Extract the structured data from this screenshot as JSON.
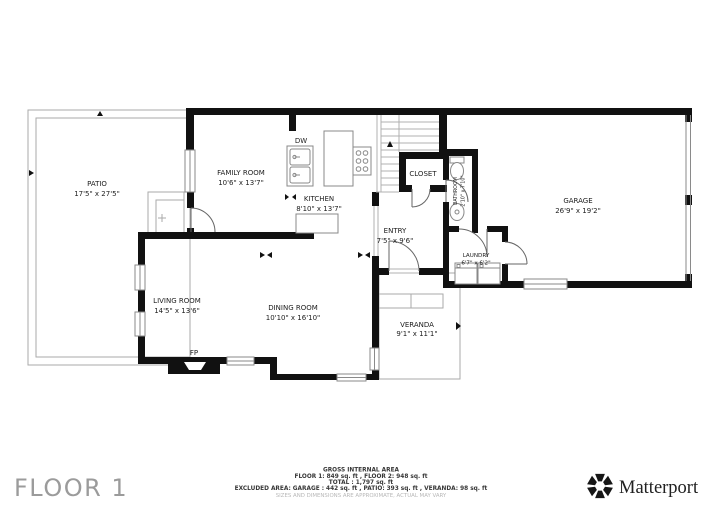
{
  "plan": {
    "rooms": {
      "patio": {
        "name": "PATIO",
        "dims": "17'5\" x 27'5\""
      },
      "family_room": {
        "name": "FAMILY ROOM",
        "dims": "10'6\" x 13'7\""
      },
      "kitchen": {
        "name": "KITCHEN",
        "dims": "8'10\" x 13'7\""
      },
      "closet": {
        "name": "CLOSET"
      },
      "bathroom": {
        "name": "BATHROOM",
        "dims": "2'10\" x 7'10\""
      },
      "garage": {
        "name": "GARAGE",
        "dims": "26'9\" x 19'2\""
      },
      "entry": {
        "name": "ENTRY",
        "dims": "7'5\" x 9'6\""
      },
      "laundry": {
        "name": "LAUNDRY",
        "dims": "6'7\" x 6'2\""
      },
      "living_room": {
        "name": "LIVING ROOM",
        "dims": "14'5\" x 13'6\""
      },
      "dining_room": {
        "name": "DINING ROOM",
        "dims": "10'10\" x 16'10\""
      },
      "veranda": {
        "name": "VERANDA",
        "dims": "9'1\" x 11'1\""
      }
    },
    "fixture_labels": {
      "dishwasher": "DW",
      "fireplace": "FP"
    }
  },
  "footer": {
    "floor_title": "FLOOR 1",
    "area_summary": {
      "title": "GROSS INTERNAL AREA",
      "floors": "FLOOR 1: 849 sq. ft , FLOOR 2: 948 sq. ft",
      "total": "TOTAL : 1,797 sq. ft",
      "excluded": "EXCLUDED AREA: GARAGE : 442 sq. ft , PATIO: 393 sq. ft , VERANDA: 98 sq. ft",
      "disclaimer": "SIZES AND DIMENSIONS ARE APPROXIMATE, ACTUAL MAY VARY"
    },
    "brand": {
      "name": "Matterport"
    }
  },
  "colors": {
    "wall": "#111111",
    "thin_line": "#aaaaaa",
    "label": "#1c1c1c",
    "floor_title": "#9b9b9b",
    "disclaimer": "#b8b8b8",
    "brand_text": "#212121"
  }
}
